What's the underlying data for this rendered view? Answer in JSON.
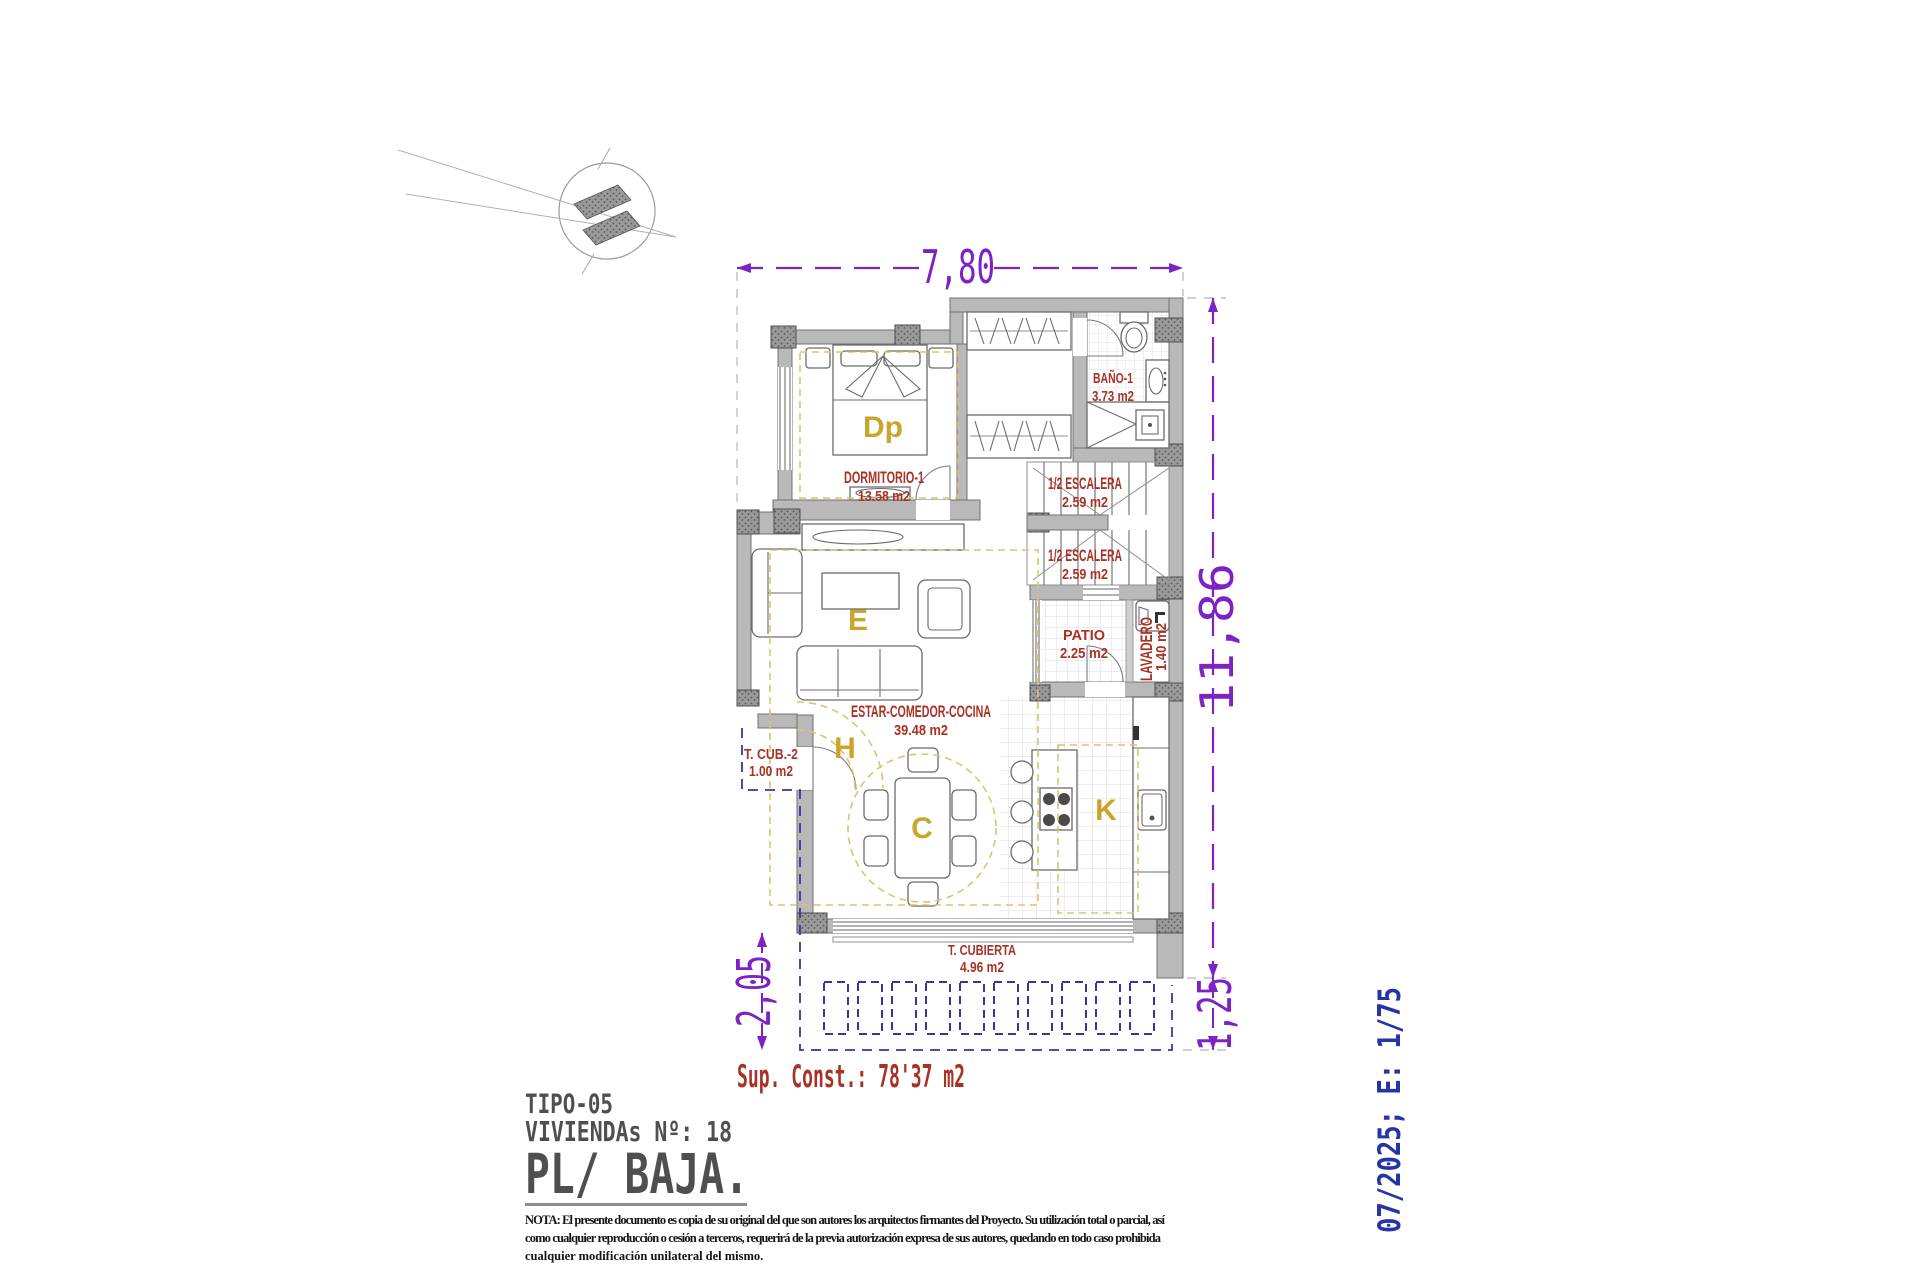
{
  "sheet": {
    "dimensions": {
      "top": "7,80",
      "right": "11,86",
      "bottom_left": "2,05",
      "bottom_right": "1,25"
    },
    "rooms": {
      "bano": {
        "name": "BAÑO-1",
        "area": "3.73 m2"
      },
      "dormitorio": {
        "name": "DORMITORIO-1",
        "area": "13.58 m2"
      },
      "escalera1": {
        "name": "1/2 ESCALERA",
        "area": "2.59 m2"
      },
      "escalera2": {
        "name": "1/2 ESCALERA",
        "area": "2.59 m2"
      },
      "patio": {
        "name": "PATIO",
        "area": "2.25 m2"
      },
      "lavadero": {
        "name": "LAVADERO",
        "area": "1.40 m2"
      },
      "estar": {
        "name": "ESTAR-COMEDOR-COCINA",
        "area": "39.48 m2"
      },
      "terraza_cubierta_2": {
        "name": "T. CUB.-2",
        "area": "1.00 m2"
      },
      "terraza_cubierta": {
        "name": "T. CUBIERTA",
        "area": "4.96 m2"
      }
    },
    "zones": {
      "dormitorio_principal": "Dp",
      "estar": "E",
      "hall": "H",
      "comedor": "C",
      "cocina": "K"
    },
    "summary": {
      "sup_const": "Sup. Const.: 78'37 m2"
    },
    "title_block": {
      "tipo": "TIPO-05",
      "viviendas": "VIVIENDAs Nº: 18",
      "planta": "PL/ BAJA."
    },
    "note": {
      "lines": [
        "NOTA: El presente documento es copia de su original del que son autores los arquitectos firmantes del Proyecto. Su utilización total o parcial, así",
        "como cualquier reproducción o cesión a terceros, requerirá  de la previa autorización expresa de sus autores, quedando en todo caso prohibida",
        "cualquier modificación unilateral del mismo."
      ]
    },
    "stamp": "07/2025; E: 1/75",
    "colors": {
      "dimension": "#7D22C4",
      "room_label": "#A93226",
      "zone_letter": "#C9A62B",
      "stamp_blue": "#2634A8",
      "pergola_blue": "#34379E",
      "wall_fill": "#B9B9B9",
      "title_gray": "#4F4F4F"
    }
  }
}
